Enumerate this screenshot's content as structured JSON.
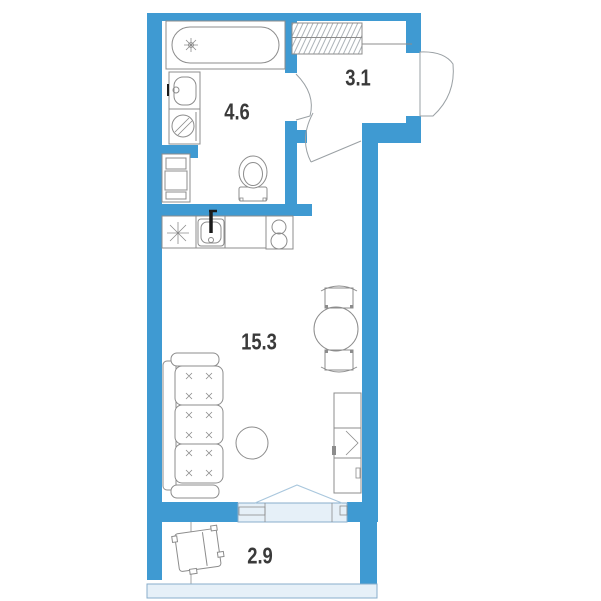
{
  "plan_title": "Studio apartment floor plan",
  "rooms": [
    {
      "id": "hallway",
      "area": "3.1"
    },
    {
      "id": "bathroom",
      "area": "4.6"
    },
    {
      "id": "living-room",
      "area": "15.3"
    },
    {
      "id": "balcony",
      "area": "2.9"
    }
  ],
  "colors": {
    "background": "#ffffff",
    "wall": "#3f9ad2",
    "fixture_outline": "#8c8c8c",
    "glazing_fill": "#e6f0f8",
    "glazing_stroke": "#88aecb",
    "door_swing": "#9aa0a4",
    "balcony_door_lines": "#a9c7dd",
    "label_text": "#3a3a3a"
  }
}
